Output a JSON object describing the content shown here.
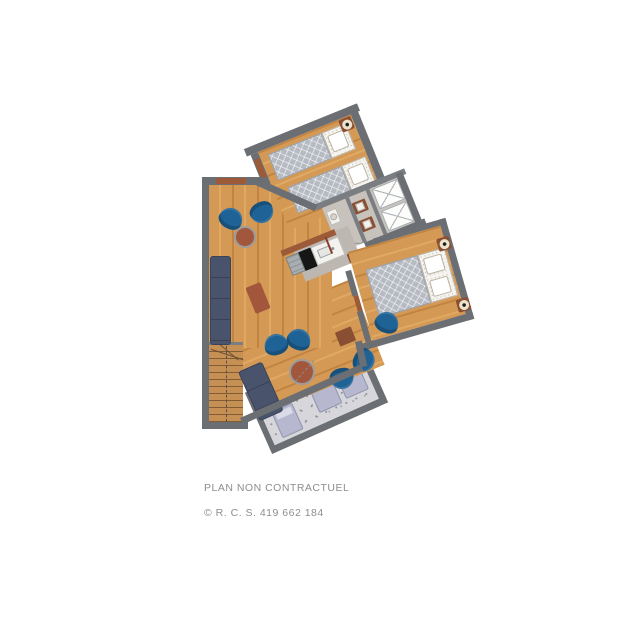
{
  "caption": {
    "line1": "PLAN NON CONTRACTUEL",
    "line2": "© R. C. S. 419 662 184"
  },
  "palette": {
    "page_bg": "#ffffff",
    "wall": "#6b6e72",
    "wall_inner": "#7a7d81",
    "wood": "#d49a55",
    "wood_stripe": "#c28441",
    "wood_light": "#dfa963",
    "gray_floor": "#c7c2bb",
    "hall_floor": "#bcb7b0",
    "balcony_floor": "#d6d6db",
    "balcony_speck": "#8f8f98",
    "quilt": "#b6bac2",
    "quilt_line": "#9aa0a9",
    "linen": "#f6f4ef",
    "chair_blue": "#1f6295",
    "table_brown": "#a2573d",
    "sofa_navy": "#49536b",
    "door_brown": "#9c5a38",
    "vanity_brown": "#8a4f33",
    "accent_red": "#8a3d2a",
    "stair_wood": "#c69055",
    "lounger": "#b7b8cf",
    "lounger_pillow": "#dadae8",
    "sconce_cream": "#ece3cd",
    "white_fixture": "#f4f2ee",
    "text_gray": "#8e8e8e"
  }
}
